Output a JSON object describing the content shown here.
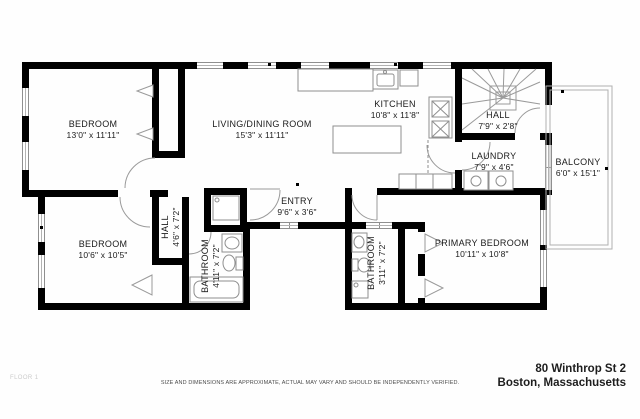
{
  "floorplan": {
    "floor_label": "FLOOR 1",
    "rooms": {
      "bedroom1": {
        "name": "BEDROOM",
        "dims": "13'0\" x 11'11\""
      },
      "living_dining": {
        "name": "LIVING/DINING ROOM",
        "dims": "15'3\" x 11'11\""
      },
      "kitchen": {
        "name": "KITCHEN",
        "dims": "10'8\" x 11'8\""
      },
      "hall_upper": {
        "name": "HALL",
        "dims": "7'9\" x 2'8\""
      },
      "laundry": {
        "name": "LAUNDRY",
        "dims": "7'9\" x 4'6\""
      },
      "balcony": {
        "name": "BALCONY",
        "dims": "6'0\" x 15'1\""
      },
      "entry": {
        "name": "ENTRY",
        "dims": "9'6\" x 3'6\""
      },
      "hall_lower": {
        "name": "HALL",
        "dims": "4'6\" x 7'2\""
      },
      "bedroom2": {
        "name": "BEDROOM",
        "dims": "10'6\" x 10'5\""
      },
      "bathroom1": {
        "name": "BATHROOM",
        "dims": "4'11\" x 7'2\""
      },
      "bathroom2": {
        "name": "BATHROOM",
        "dims": "3'11\" x 7'2\""
      },
      "primary_bedroom": {
        "name": "PRIMARY BEDROOM",
        "dims": "10'11\" x 10'8\""
      }
    }
  },
  "footer": {
    "disclaimer": "SIZE AND DIMENSIONS ARE APPROXIMATE, ACTUAL MAY VARY AND SHOULD BE INDEPENDENTLY VERIFIED.",
    "address_line1": "80 Winthrop St 2",
    "address_line2": "Boston, Massachusetts"
  },
  "colors": {
    "wall": "#000000",
    "thin_line": "#999999",
    "background": "#fefefe"
  }
}
